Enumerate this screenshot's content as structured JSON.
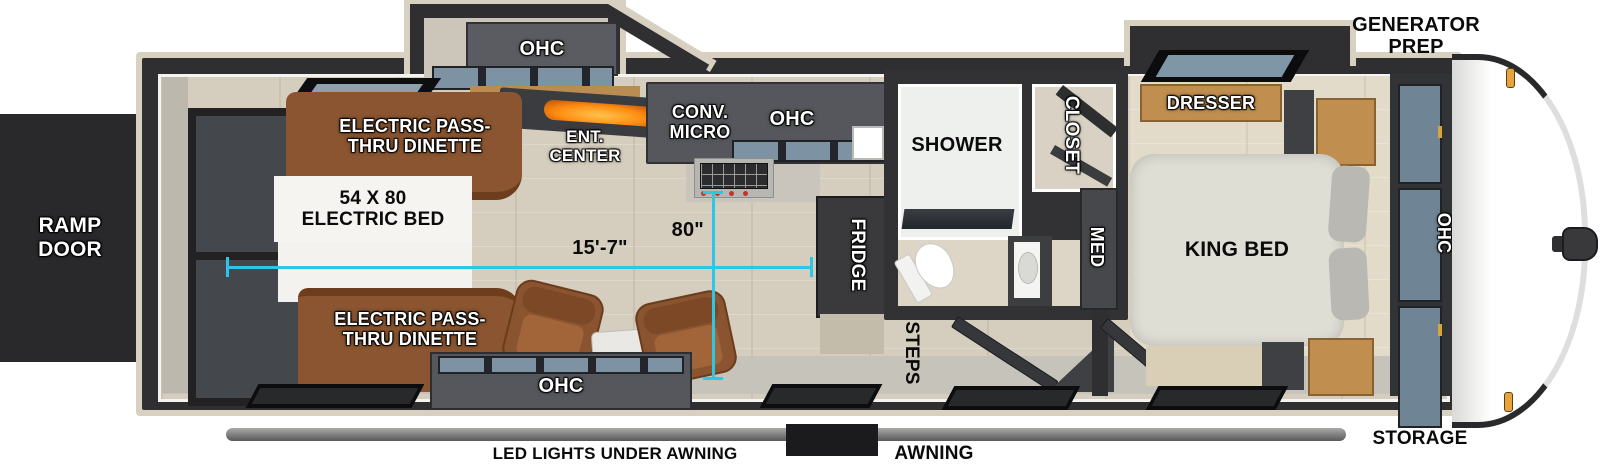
{
  "exterior": {
    "ramp_door": "RAMP DOOR",
    "generator_prep": "GENERATOR PREP",
    "storage": "STORAGE",
    "awning": "AWNING",
    "led_lights": "LED LIGHTS UNDER AWNING"
  },
  "dimensions": {
    "interior_length": "15'-7\"",
    "interior_width": "80\""
  },
  "garage": {
    "dinette_front": "ELECTRIC PASS-THRU DINETTE",
    "electric_bed": "54 X 80 ELECTRIC BED",
    "dinette_rear": "ELECTRIC PASS-THRU DINETTE",
    "ohc_slide": "OHC",
    "ent_center": "ENT. CENTER",
    "ohc_rear": "OHC"
  },
  "kitchen": {
    "conv_micro": "CONV. MICRO",
    "ohc": "OHC",
    "fridge": "FRIDGE"
  },
  "bath": {
    "shower": "SHOWER",
    "closet": "CLOSET",
    "med": "MED",
    "steps": "STEPS"
  },
  "bedroom": {
    "dresser": "DRESSER",
    "king_bed": "KING BED",
    "ohc": "OHC"
  },
  "colors": {
    "wall": "#2f2f31",
    "dimension_accent": "#2bc7e6",
    "sofa_brown": "#8a5530",
    "cabinet_gray": "#55575c",
    "wood_tone": "#c08e4e",
    "front_cap": "#ffffff"
  }
}
